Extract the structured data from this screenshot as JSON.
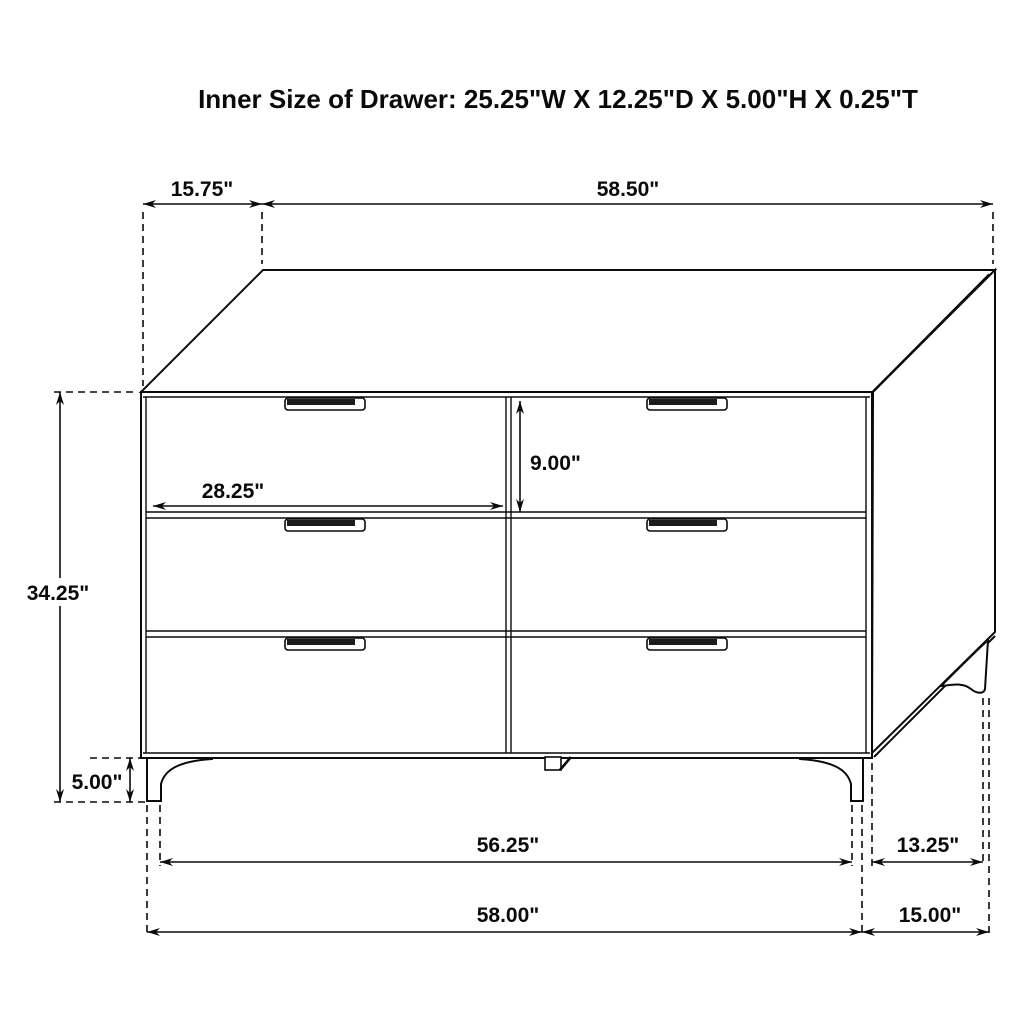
{
  "title": "Inner Size of Drawer: 25.25\"W X 12.25\"D X 5.00\"H X 0.25\"T",
  "dimensions": {
    "top_depth": "15.75\"",
    "top_width": "58.50\"",
    "overall_height": "34.25\"",
    "leg_height": "5.00\"",
    "drawer_face_width": "28.25\"",
    "drawer_face_height": "9.00\"",
    "feet_inner_span": "56.25\"",
    "side_feet_span": "13.25\"",
    "overall_width": "58.00\"",
    "overall_depth": "15.00\""
  },
  "colors": {
    "line": "#0a0a0a",
    "background": "#ffffff",
    "handle": "#1c1c1c"
  }
}
